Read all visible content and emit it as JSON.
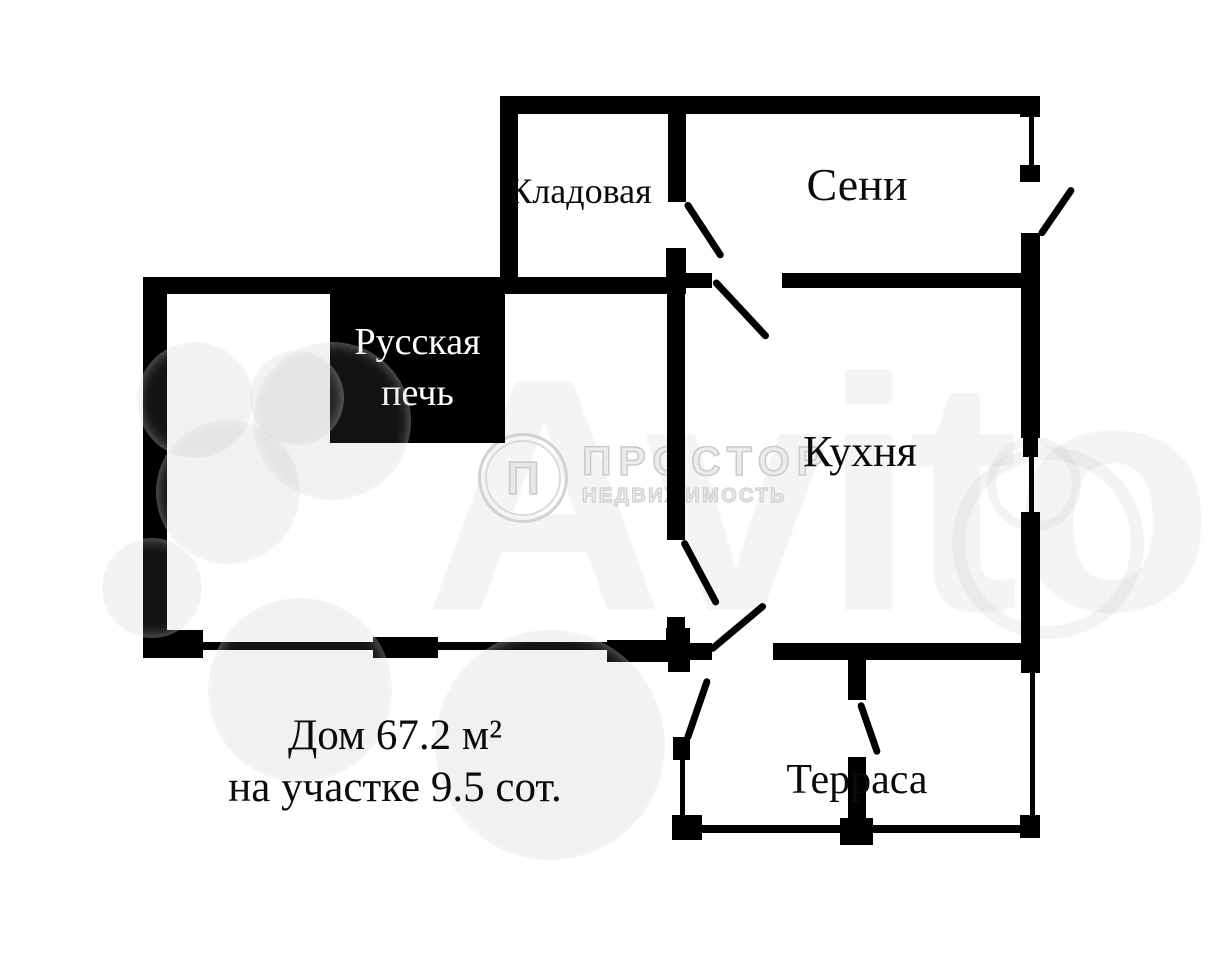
{
  "plan": {
    "rooms": [
      {
        "label": "Кладовая"
      },
      {
        "label": "Сени"
      },
      {
        "label": "Кухня"
      },
      {
        "label": "Терраса"
      }
    ],
    "stove": {
      "line1": "Русская",
      "line2": "печь"
    },
    "area_note": {
      "line1": "Дом 67.2 м²",
      "line2": "на участке 9.5 сот."
    }
  },
  "watermarks": {
    "agency_name": "ПРОСТОР",
    "agency_subtitle": "НЕДВИЖИМОСТЬ",
    "agency_logo_glyph": "П",
    "marketplace": "Avito"
  },
  "colors": {
    "wall": "#000000",
    "background": "#ffffff",
    "stove_text": "#ffffff",
    "label_text": "#0b0b0b",
    "watermark_gray": "#d8d8d8"
  }
}
